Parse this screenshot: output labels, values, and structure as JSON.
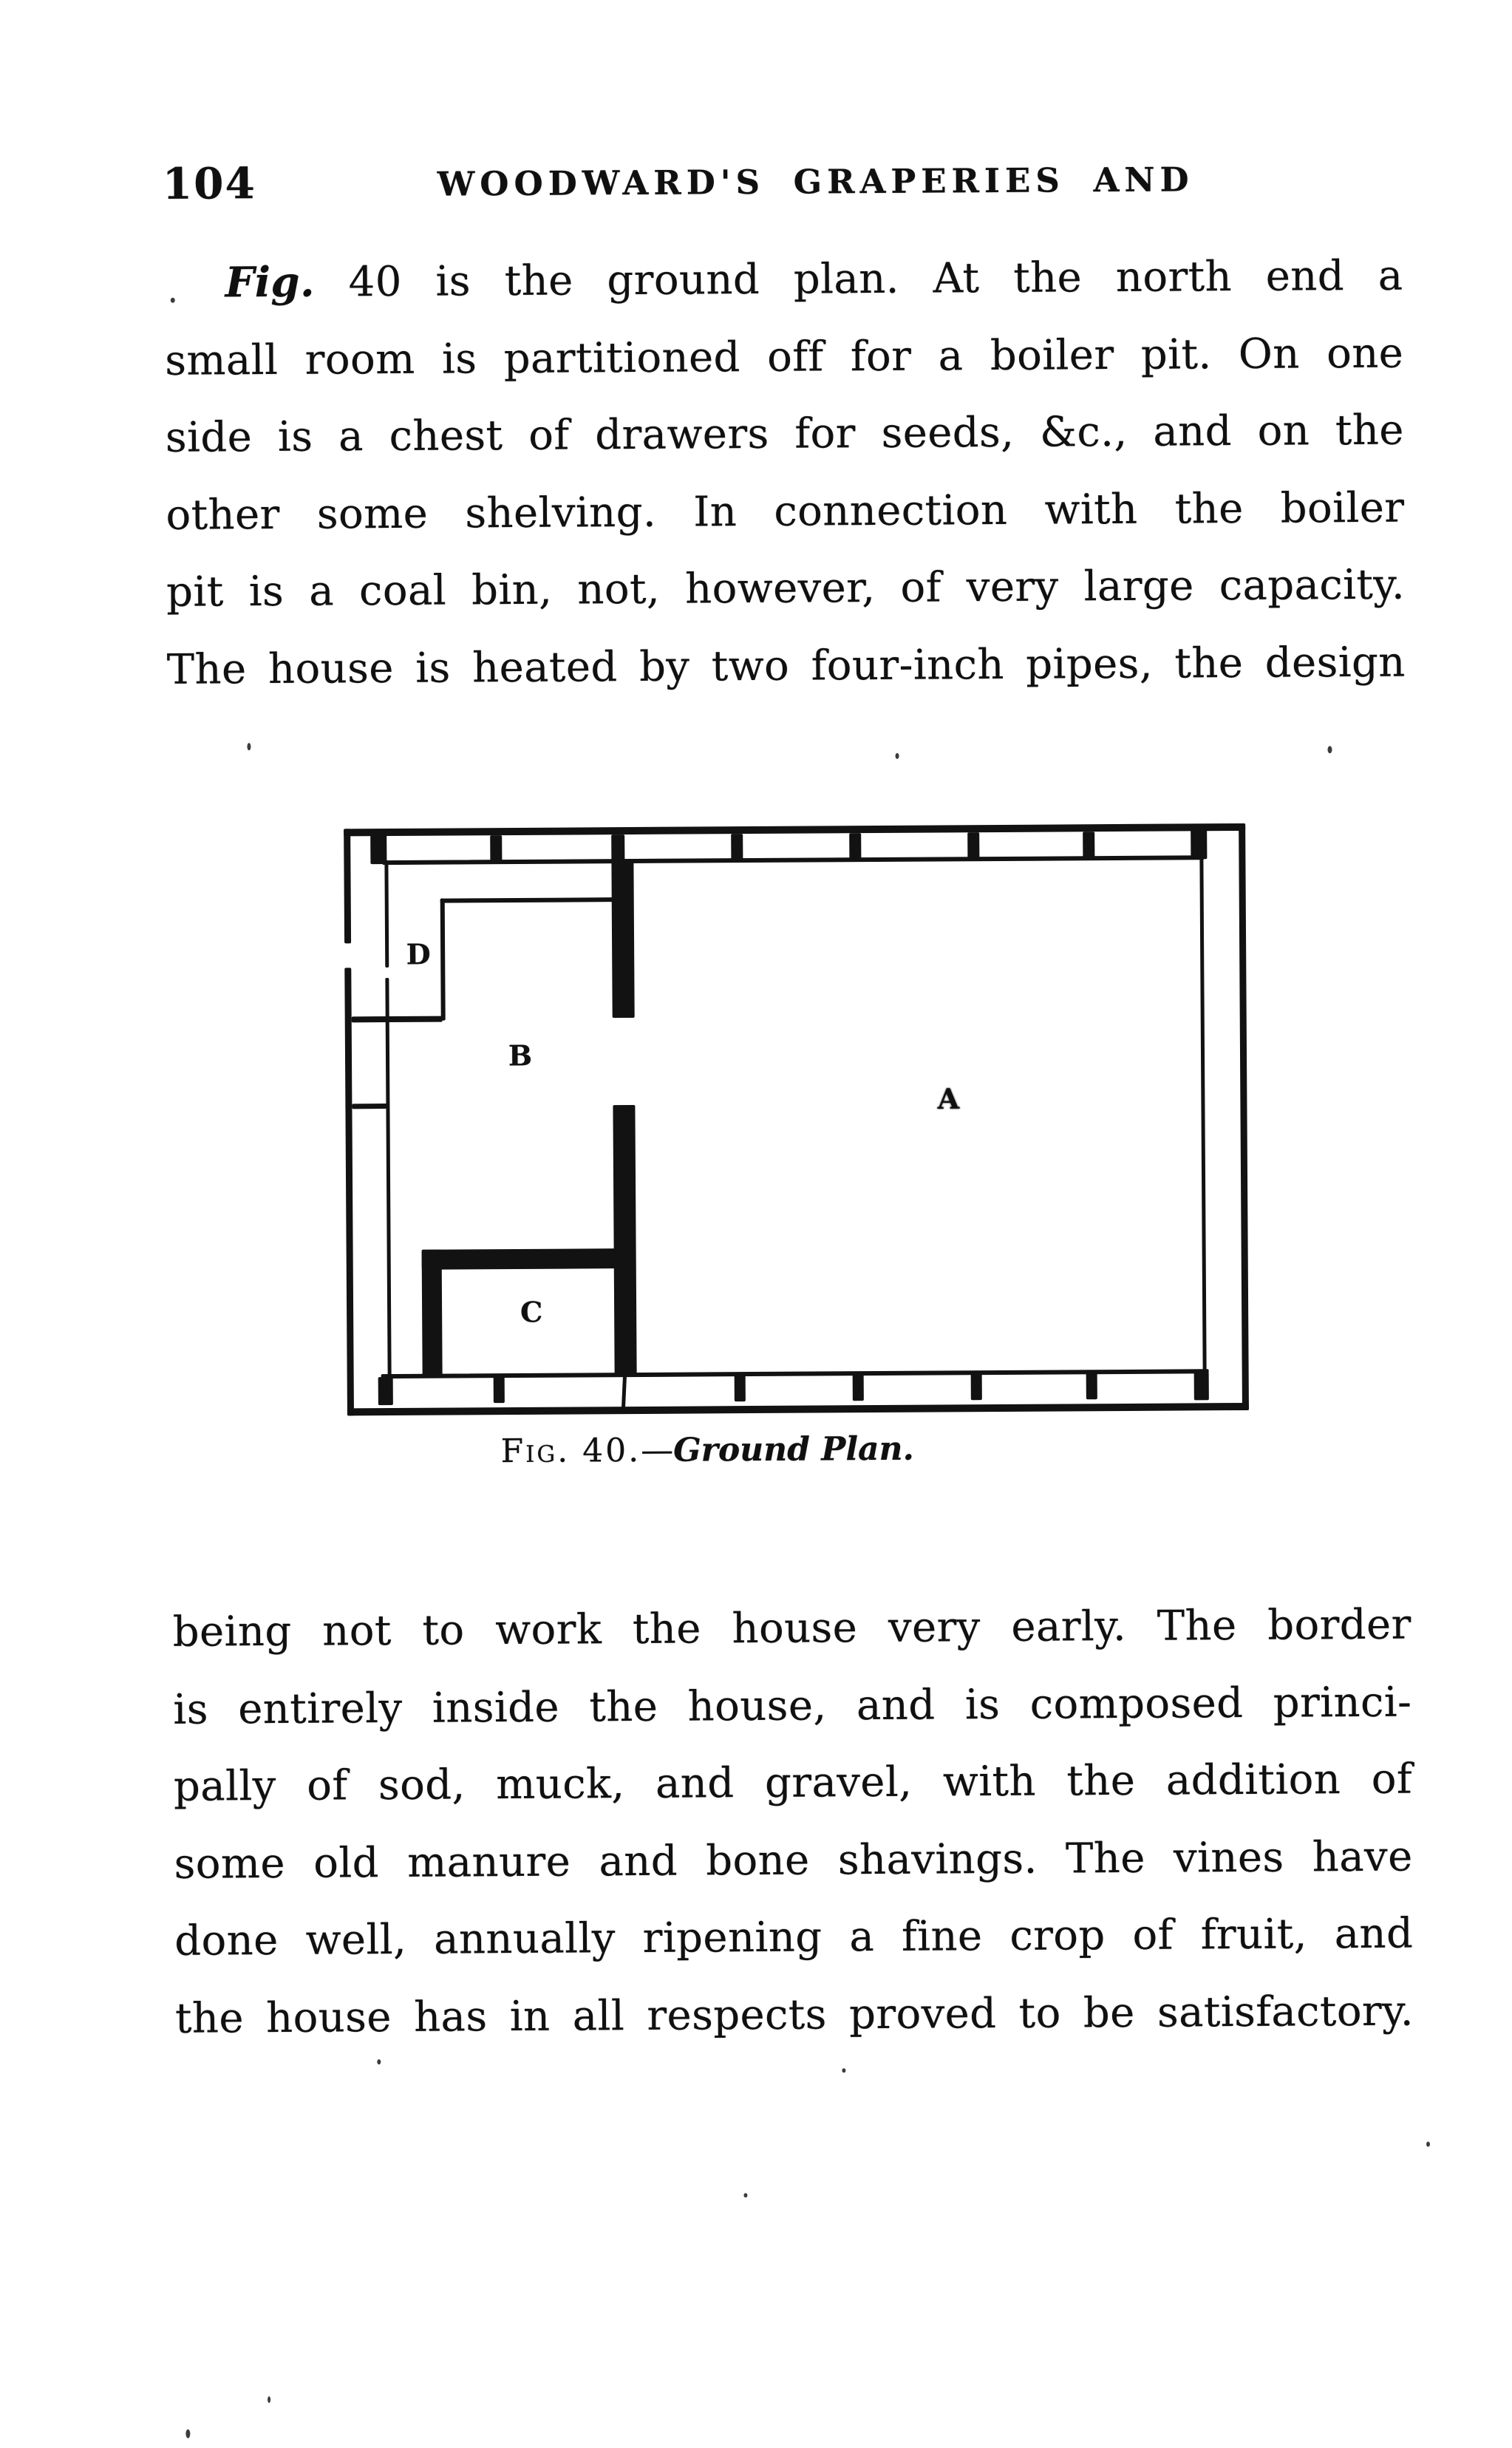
{
  "header": {
    "page_number": "104",
    "running_title": "WOODWARD'S GRAPERIES AND"
  },
  "para1": {
    "lead": "Fig.",
    "lines": [
      " 40 is the ground plan.  At the north end a",
      "small room is partitioned off for a boiler pit.  On one",
      "side is a chest of drawers for seeds, &c., and on the",
      "other some shelving.  In connection with the boiler",
      "pit is a coal bin, not, however, of very large capacity.",
      "The house is heated by two four-inch pipes, the design"
    ]
  },
  "figure": {
    "labels": {
      "a": "A",
      "b": "B",
      "c": "C",
      "d": "D"
    },
    "caption": {
      "prefix": "Fig. 40.",
      "separator": "—",
      "title": "Ground Plan."
    }
  },
  "para2": {
    "lines": [
      "being not to work the house very early.  The border",
      "is entirely inside the house, and is composed princi-",
      "pally of sod, muck, and gravel, with the addition of",
      "some old manure and bone shavings.  The vines have",
      "done well, annually ripening a fine crop of fruit, and",
      "the house has in all respects proved to be satisfactory."
    ]
  }
}
